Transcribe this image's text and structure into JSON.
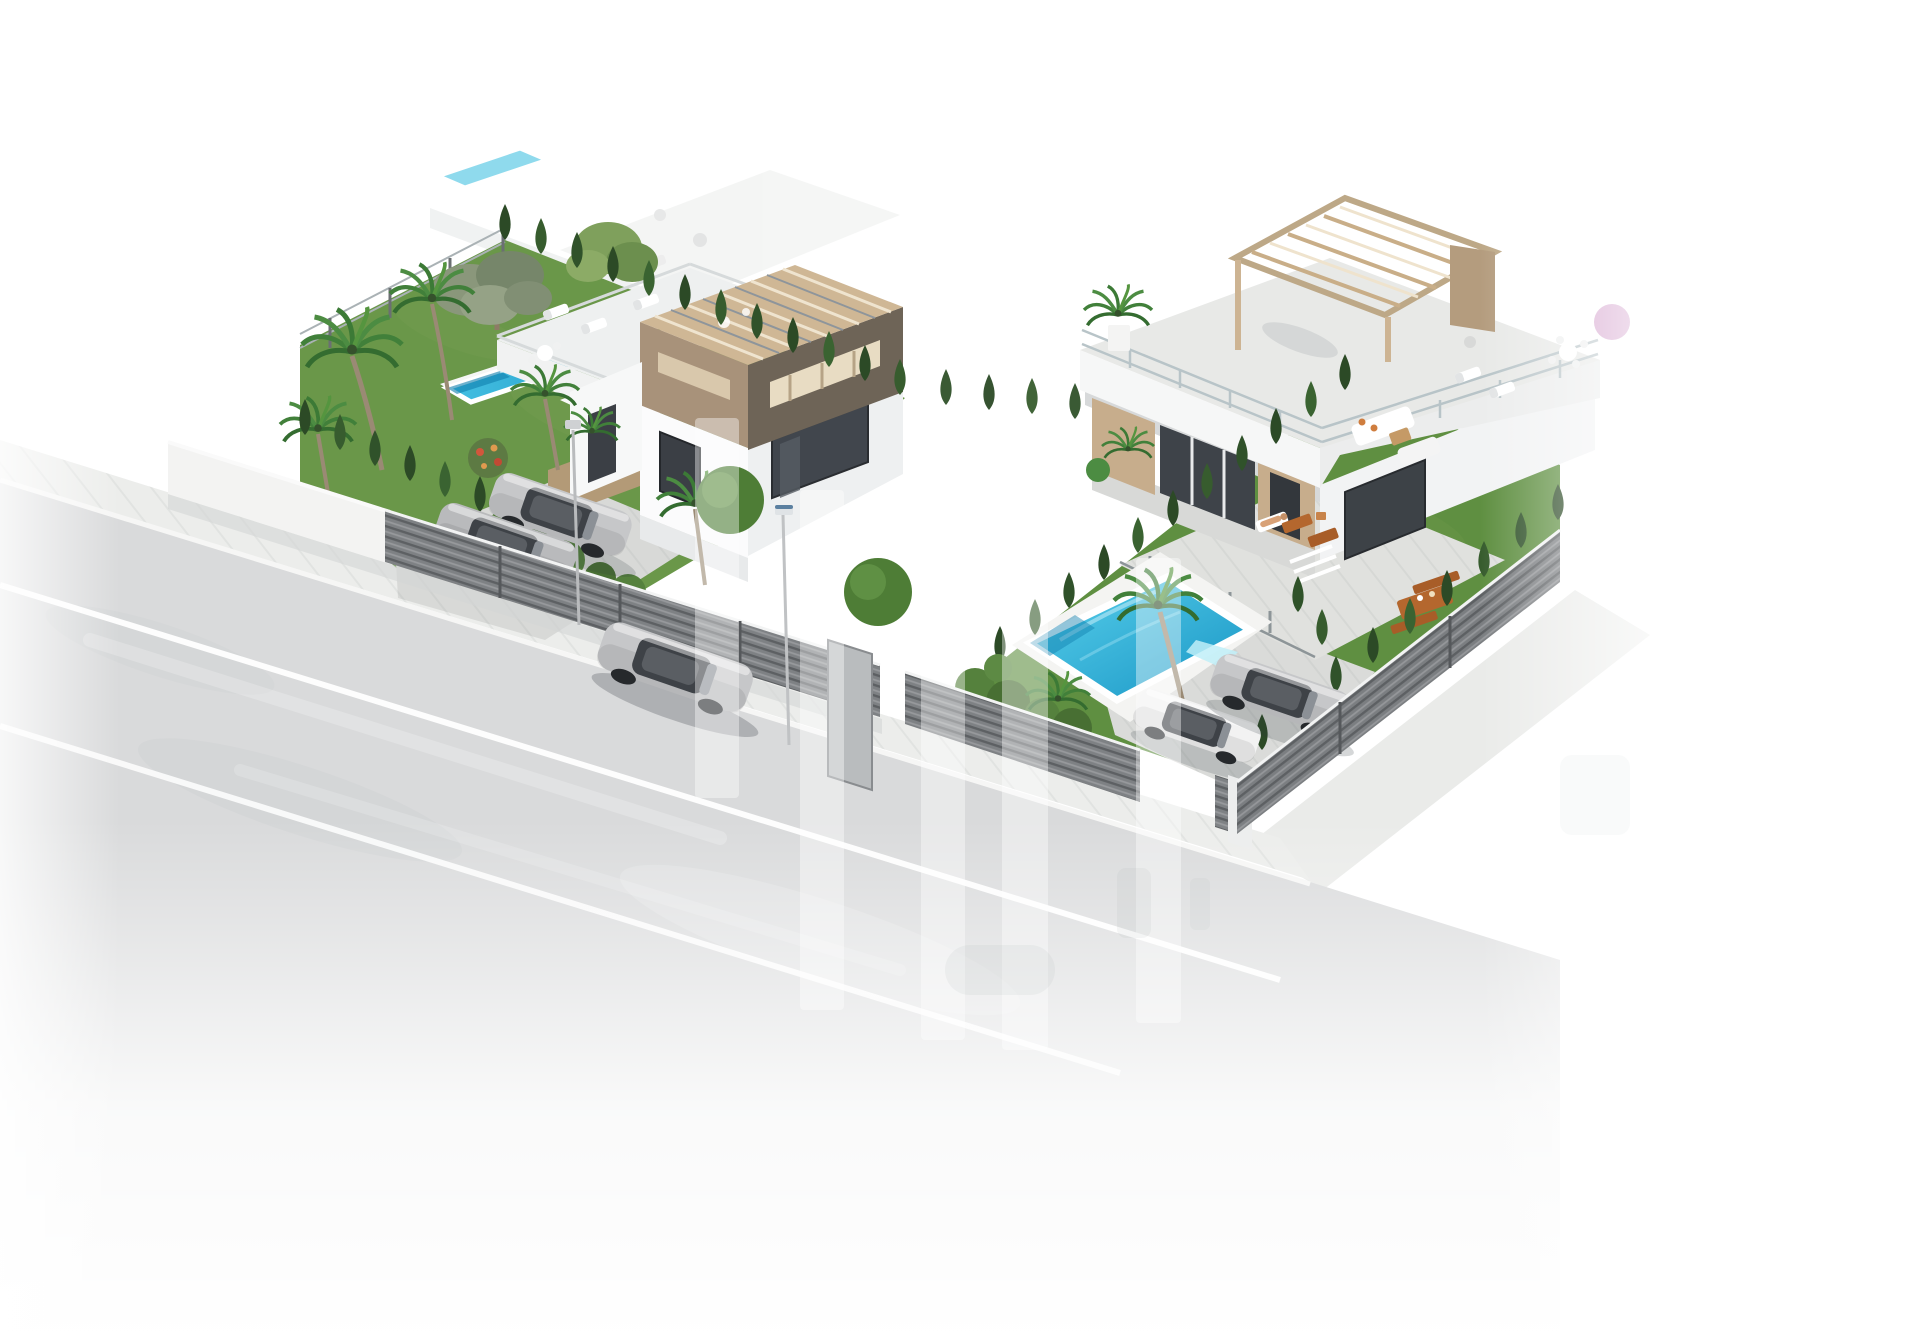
{
  "meta": {
    "type": "3d-architectural-render",
    "subject": "Aerial isometric render of two modern white villas with private pools, gardens, parked cars and a street",
    "visible_text": "none",
    "background": "#ffffff"
  },
  "palette": {
    "background": "#ffffff",
    "road": "#d9dadb",
    "sidewalk": "#ecedeb",
    "laneLine": "#fdfdfd",
    "grassLeft": "#6a9749",
    "grassRight": "#5f8f41",
    "cypress": "#2c4a26",
    "poolLight": "#5ad1ec",
    "poolDeep": "#1794c4",
    "villaWhite": "#fbfbfc",
    "villaShade": "#eef0f1",
    "pergolaTop": "#cfb795",
    "pergolaFront": "#a8927a",
    "pergolaDark": "#6e6457",
    "fenceSlat": "#7e8184",
    "fenceWall": "#f3f3f2",
    "windowDark": "#3b3f45",
    "carSilver": "#c6c7c9",
    "carWhite": "#f2f2f2",
    "wood": "#b4672e",
    "skin": "#d8a177",
    "watermark": "#ffffff"
  },
  "scene": {
    "road": {
      "label": "asphalt street with two white lane lines, fades to white at image bottom"
    },
    "left_villa": {
      "label": "villa with rooftop pergola cube, lap pool, lawn garden, carport with two silver cars"
    },
    "right_villa": {
      "label": "villa with large roof terrace, wooden pergola, rectangular pool, sun loungers and wooden furniture"
    },
    "vehicles": {
      "road_car": "silver sedan driving on street",
      "left_cars": "two silver cars behind slatted fence",
      "right_cars": "silver sedan and white car at driveway gate"
    },
    "watermark": {
      "label": "translucent vertical bar logo watermark",
      "opacity": 0.4
    }
  }
}
